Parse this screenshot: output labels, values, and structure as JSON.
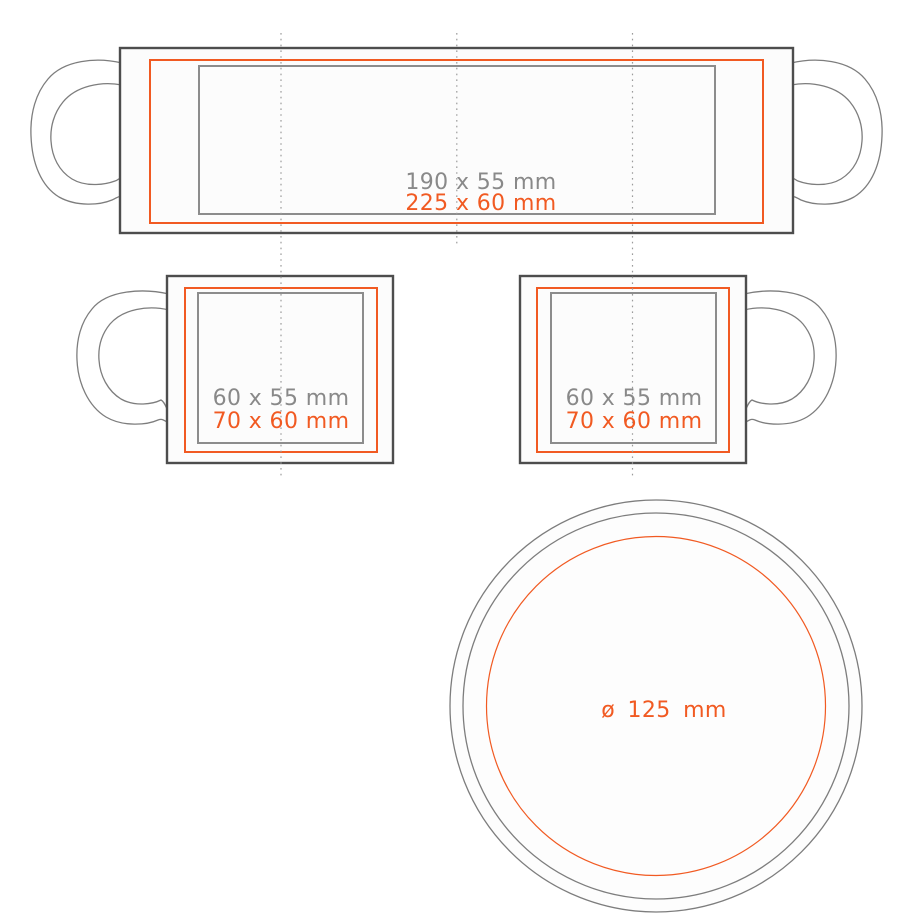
{
  "meta": {
    "description": "Mug print-area template diagram: unrolled wrap view, left-handle mug, right-handle mug, and base circle view"
  },
  "colors": {
    "accent_orange": "#f15a22",
    "outline_dark": "#4d4d4d",
    "outline_gray": "#8c8c8c",
    "handle_gray": "#7d7d7d",
    "guide_gray": "#9b9b9b",
    "label_gray": "#898989"
  },
  "figures": {
    "wrap": {
      "print_label": "190 x 55 mm",
      "max_label": "225 x 60 mm"
    },
    "mug_left": {
      "print_label": "60 x 55 mm",
      "max_label": "70 x 60 mm"
    },
    "mug_right": {
      "print_label": "60 x 55 mm",
      "max_label": "70 x 60 mm"
    },
    "base": {
      "diameter_label": "ø 125 mm"
    }
  }
}
